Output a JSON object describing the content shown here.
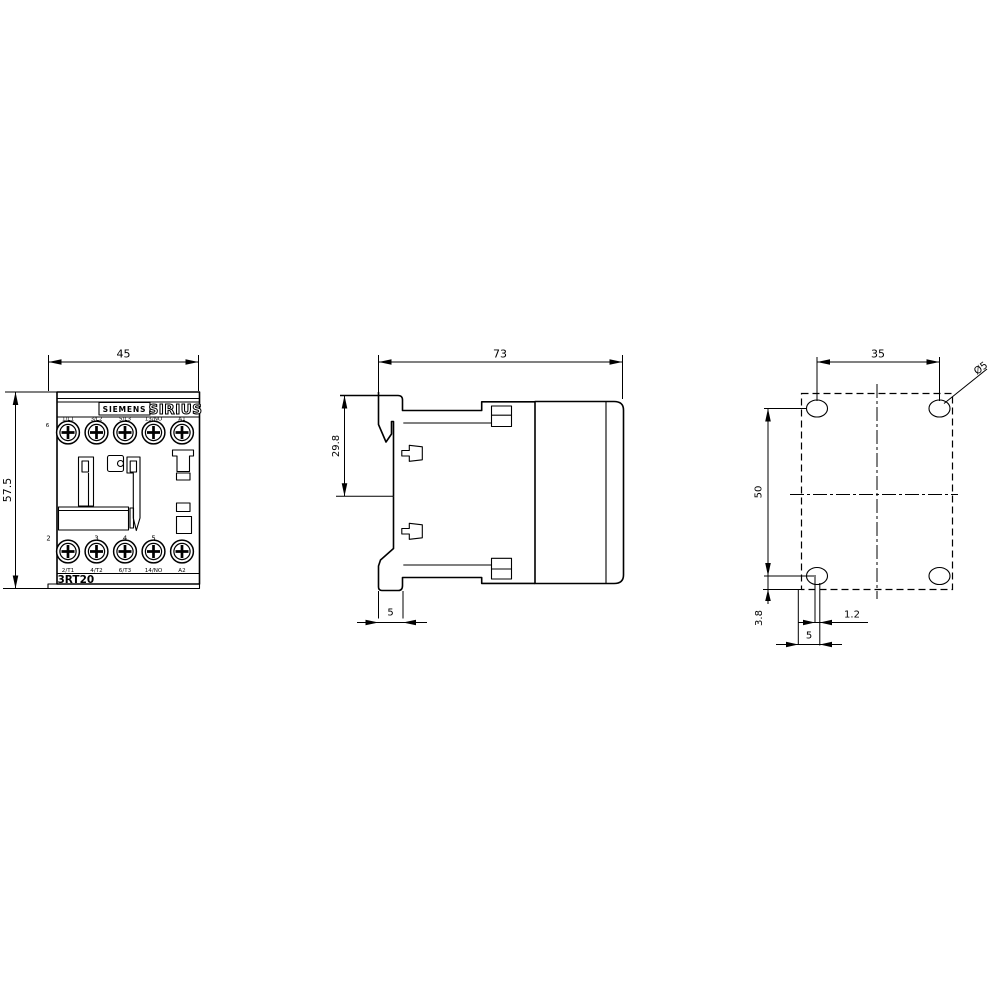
{
  "drawing": {
    "front": {
      "brand": "SIEMENS",
      "series": "SIRIUS",
      "model": "3RT20",
      "width_dim": "45",
      "height_dim": "57.5",
      "corner_mark_top": "6",
      "pole_numbers": [
        "2",
        "3",
        "4",
        "5"
      ],
      "terminals_top": [
        "1/L1",
        "3/L2",
        "5/L3",
        "13/NO",
        "A1"
      ],
      "terminals_bottom": [
        "2/T1",
        "4/T2",
        "6/T3",
        "14/NO",
        "A2"
      ]
    },
    "side": {
      "depth_dim": "73",
      "rail_dim": "29.8",
      "foot_dim": "5"
    },
    "mounting": {
      "hole_spacing_x": "35",
      "hole_spacing_y": "50",
      "hole_dia": "Ø5",
      "offset_y": "3.8",
      "offset_x": "1.2",
      "slot_dim": "5"
    },
    "colors": {
      "line": "#000000",
      "bg": "#ffffff"
    }
  }
}
